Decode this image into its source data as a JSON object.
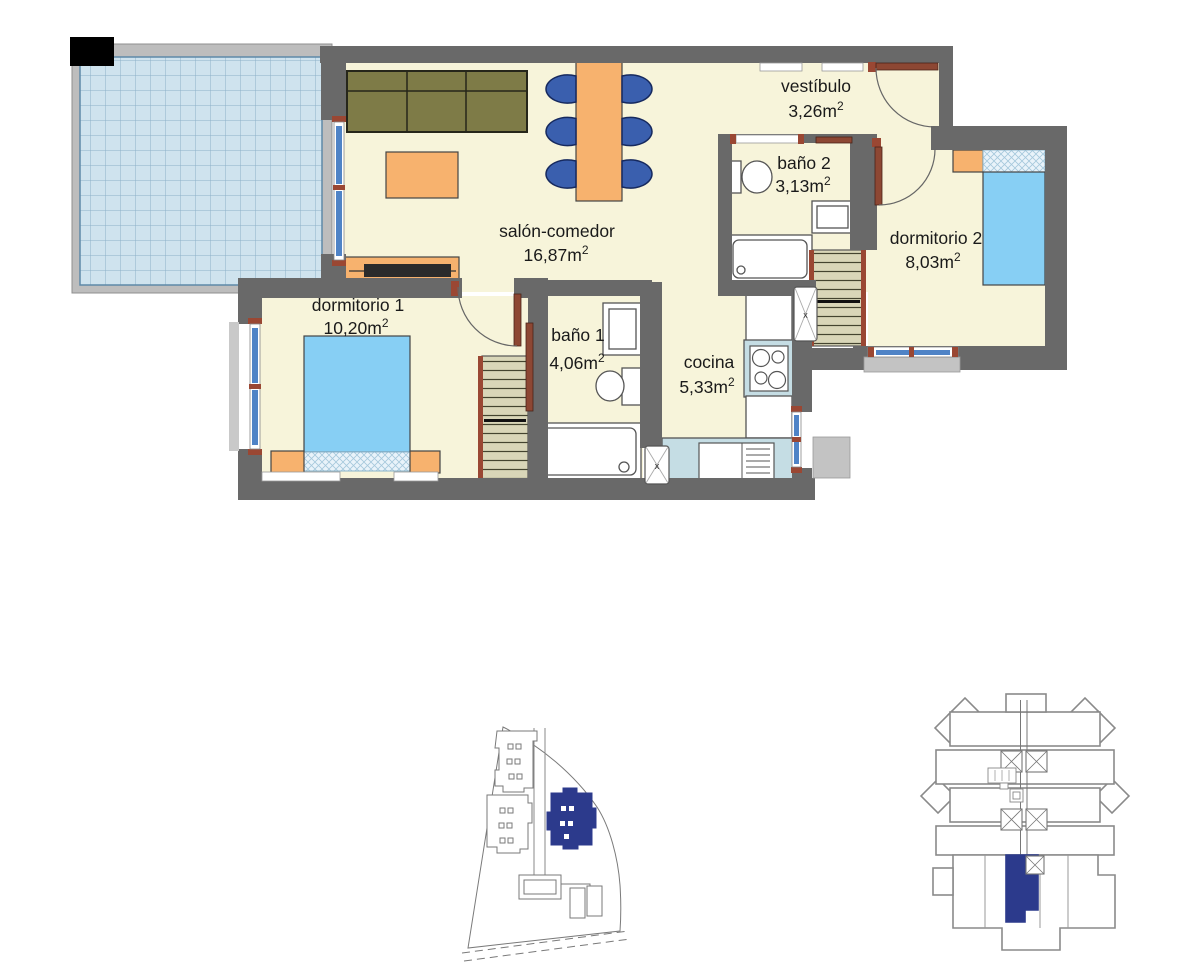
{
  "document": {
    "kind": "apartment floor plan"
  },
  "rooms": [
    {
      "name": "vestíbulo",
      "area": "3,26m",
      "area_sup": "2"
    },
    {
      "name": "baño 2",
      "area": "3,13m",
      "area_sup": "2"
    },
    {
      "name": "dormitorio 2",
      "area": "8,03m",
      "area_sup": "2"
    },
    {
      "name": "salón-comedor",
      "area": "16,87m",
      "area_sup": "2"
    },
    {
      "name": "dormitorio 1",
      "area": "10,20m",
      "area_sup": "2"
    },
    {
      "name": "baño 1",
      "area": "4,06m",
      "area_sup": "2"
    },
    {
      "name": "cocina",
      "area": "5,33m",
      "area_sup": "2"
    }
  ],
  "markers": {
    "appliance_marker": "x"
  },
  "colors": {
    "wall": "#696969",
    "wall_light": "#bdbdbd",
    "floor": "#f7f4da",
    "terrace_tile": "#cfe3ee",
    "terrace_grid": "#8cb0c8",
    "window_glass": "#4f83c6",
    "frame_brown": "#9a4733",
    "furniture_orange": "#f7b26e",
    "sofa_olive": "#7e7b47",
    "chair_blue": "#3a5fae",
    "bed_blue": "#87cff4",
    "wardrobe_khaki": "#d9d6b8",
    "counter_blue": "#c5dde4",
    "highlight_navy": "#2c3a8c"
  },
  "minimaps": {
    "site_plan": {
      "highlighted_building_color": "#2c3a8c"
    },
    "building_plan": {
      "highlighted_unit_color": "#2c3a8c"
    }
  }
}
